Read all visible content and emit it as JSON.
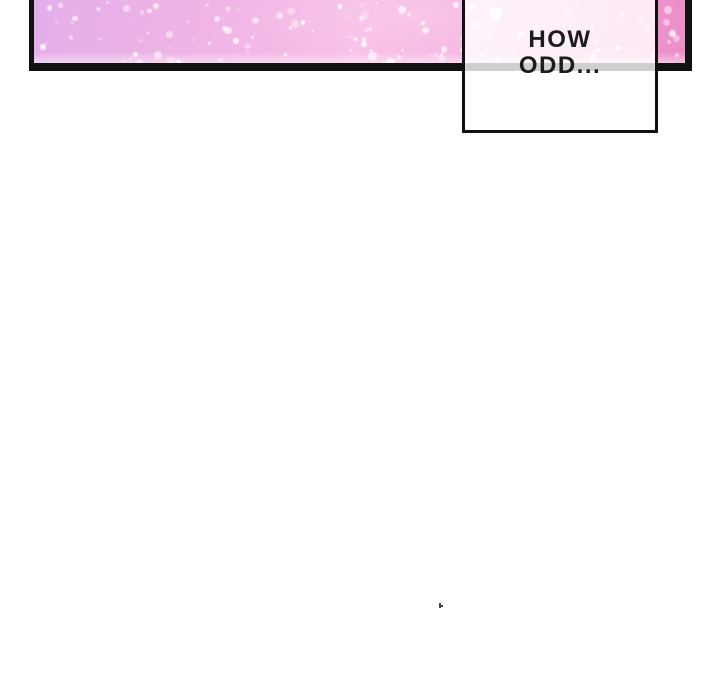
{
  "comic": {
    "page_background": "#ffffff",
    "panel": {
      "description": "pink-sparkle-gradient-panel",
      "border_color": "#111111",
      "gradient_colors": [
        "#e3aeea",
        "#efb4e5",
        "#f7bde7",
        "#f3abdc",
        "#ec8cc8"
      ],
      "sparkle_color": "#ffffff"
    },
    "speech_box": {
      "lines": [
        "HOW",
        "ODD..."
      ],
      "text_color": "#1c1c1c",
      "border_color": "#111111",
      "fill": "rgba(255,255,255,0.8)"
    },
    "stray_mark_color": "#454545"
  }
}
